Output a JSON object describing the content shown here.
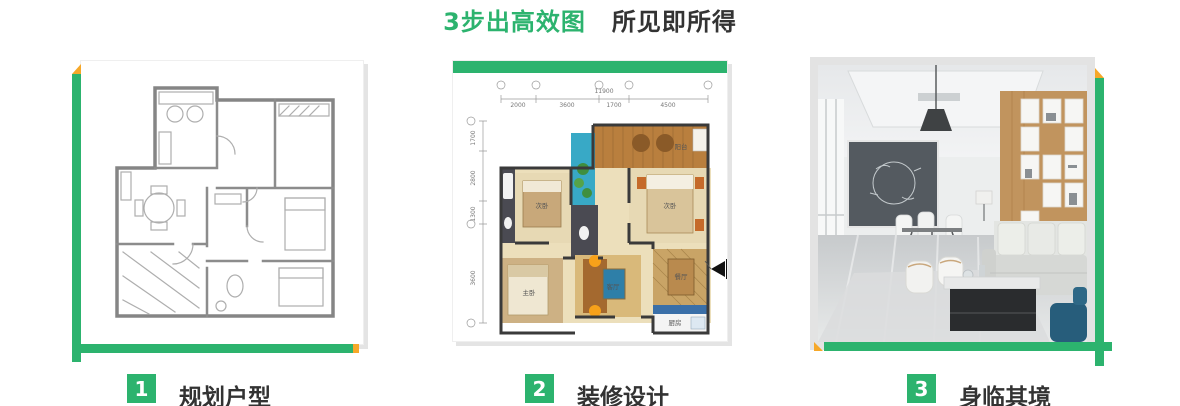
{
  "title": {
    "highlight": "3步出高效图",
    "rest": "所见即所得"
  },
  "steps": [
    {
      "number": "1",
      "label": "规划户型"
    },
    {
      "number": "2",
      "label": "装修设计"
    },
    {
      "number": "3",
      "label": "身临其境"
    }
  ],
  "floorplan": {
    "overall_width": "11900",
    "dims_top": [
      "2000",
      "3600",
      "1700",
      "4500"
    ],
    "dims_left": [
      "1700",
      "2800",
      "1300",
      "3600"
    ],
    "rooms": {
      "balcony": "阳台",
      "bedroom_right": "次卧",
      "bedroom_left": "次卧",
      "master": "主卧",
      "living": "客厅",
      "dining": "餐厅",
      "kitchen": "厨房"
    }
  },
  "colors": {
    "accent_green": "#2cb36e",
    "accent_orange": "#f6a829",
    "text_dark": "#333333"
  }
}
